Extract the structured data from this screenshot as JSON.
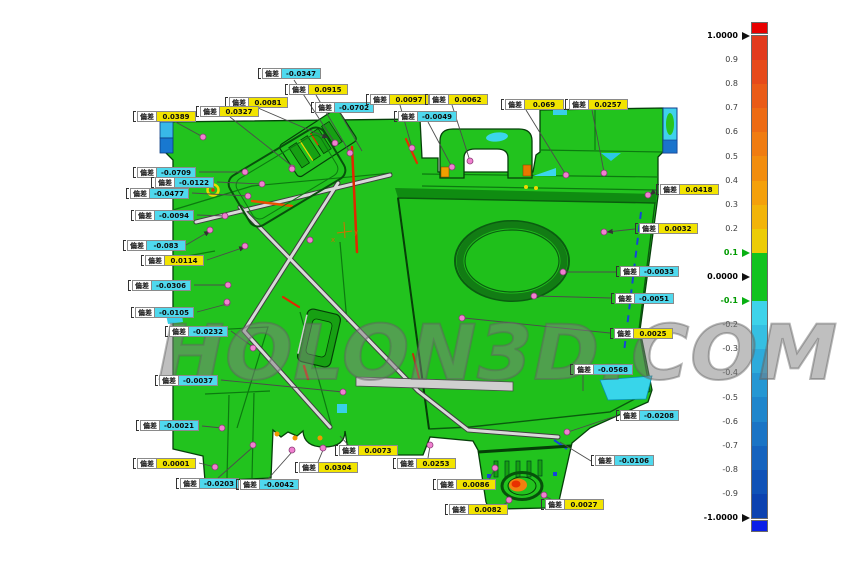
{
  "annotation_tag": "偏差",
  "watermark": {
    "text": "HOLON3D.COM"
  },
  "colors": {
    "positive_bg": "#f2e400",
    "negative_bg": "#4fd9ee",
    "part_green": "#22c31e",
    "measure_point": "#f080d0",
    "overflow_red": "#e80000",
    "underflow_blue": "#0b1fe8",
    "hotspot_orange": "#f08010"
  },
  "annotations": [
    {
      "value": "-0.0347",
      "x": 258,
      "y": 68,
      "leader": [
        294,
        80,
        335,
        143
      ],
      "dot": [
        335,
        143
      ]
    },
    {
      "value": "0.0915",
      "x": 285,
      "y": 84,
      "leader": [
        316,
        95,
        350,
        153
      ],
      "dot": [
        350,
        153
      ]
    },
    {
      "value": "0.0081",
      "x": 225,
      "y": 97,
      "leader": [
        258,
        108,
        328,
        138
      ],
      "arrow": true
    },
    {
      "value": "0.0327",
      "x": 196,
      "y": 106,
      "leader": [
        230,
        117,
        292,
        166
      ],
      "dot": [
        292,
        168
      ]
    },
    {
      "value": "0.0389",
      "x": 133,
      "y": 111,
      "leader": [
        172,
        120,
        203,
        137
      ],
      "dot": [
        203,
        137
      ]
    },
    {
      "value": "-0.0702",
      "x": 311,
      "y": 102,
      "leader": [
        340,
        113,
        362,
        151
      ]
    },
    {
      "value": "0.0097",
      "x": 366,
      "y": 94,
      "leader": [
        400,
        105,
        412,
        148
      ],
      "dot": [
        412,
        148
      ]
    },
    {
      "value": "0.0062",
      "x": 425,
      "y": 94,
      "leader": [
        452,
        105,
        470,
        161
      ],
      "dot": [
        470,
        161
      ]
    },
    {
      "value": "-0.0049",
      "x": 394,
      "y": 111,
      "leader": [
        428,
        122,
        452,
        167
      ],
      "dot": [
        452,
        167
      ]
    },
    {
      "value": "0.069",
      "x": 501,
      "y": 99,
      "leader": [
        526,
        110,
        566,
        175
      ],
      "dot": [
        566,
        175
      ]
    },
    {
      "value": "0.0257",
      "x": 565,
      "y": 99,
      "leader": [
        592,
        110,
        604,
        172
      ],
      "dot": [
        604,
        173
      ]
    },
    {
      "value": "-0.0709",
      "x": 133,
      "y": 167,
      "leader": [
        199,
        172,
        245,
        172
      ],
      "dot": [
        245,
        172
      ]
    },
    {
      "value": "-0.0122",
      "x": 151,
      "y": 177,
      "leader": [
        217,
        182,
        262,
        184
      ],
      "dot": [
        262,
        184
      ]
    },
    {
      "value": "-0.0477",
      "x": 126,
      "y": 188,
      "leader": [
        192,
        193,
        248,
        196
      ],
      "dot": [
        248,
        196
      ]
    },
    {
      "value": "-0.0094",
      "x": 131,
      "y": 210,
      "leader": [
        197,
        215,
        225,
        216
      ],
      "dot": [
        225,
        216
      ]
    },
    {
      "value": "-0.083",
      "x": 123,
      "y": 240,
      "leader": [
        186,
        245,
        210,
        231
      ],
      "arrow": true,
      "dot": [
        210,
        230
      ]
    },
    {
      "value": "0.0114",
      "x": 141,
      "y": 255,
      "leader": [
        207,
        260,
        245,
        247
      ],
      "arrow": true,
      "dot": [
        245,
        246
      ]
    },
    {
      "value": "-0.0306",
      "x": 128,
      "y": 280,
      "leader": [
        194,
        285,
        228,
        285
      ],
      "dot": [
        228,
        285
      ]
    },
    {
      "value": "-0.0105",
      "x": 131,
      "y": 307,
      "leader": [
        197,
        312,
        227,
        304
      ],
      "dot": [
        227,
        303
      ]
    },
    {
      "value": "-0.0232",
      "x": 165,
      "y": 326,
      "leader": [
        231,
        331,
        253,
        347
      ],
      "dot": [
        253,
        348
      ]
    },
    {
      "value": "-0.0037",
      "x": 155,
      "y": 375,
      "leader": [
        221,
        380,
        343,
        392
      ],
      "dot": [
        343,
        392
      ]
    },
    {
      "value": "-0.0021",
      "x": 136,
      "y": 420,
      "leader": [
        202,
        426,
        222,
        428
      ],
      "dot": [
        222,
        428
      ]
    },
    {
      "value": "0.0001",
      "x": 133,
      "y": 458,
      "leader": [
        199,
        463,
        215,
        467
      ],
      "dot": [
        215,
        467
      ]
    },
    {
      "value": "-0.0203",
      "x": 176,
      "y": 478,
      "leader": [
        218,
        478,
        253,
        447
      ],
      "dot": [
        253,
        445
      ]
    },
    {
      "value": "-0.0042",
      "x": 236,
      "y": 479,
      "leader": [
        268,
        479,
        292,
        452
      ],
      "dot": [
        292,
        450
      ]
    },
    {
      "value": "0.0304",
      "x": 295,
      "y": 462,
      "leader": [
        318,
        462,
        323,
        450
      ],
      "dot": [
        323,
        448
      ]
    },
    {
      "value": "0.0073",
      "x": 335,
      "y": 445,
      "leader": [
        352,
        449,
        340,
        436
      ]
    },
    {
      "value": "0.0253",
      "x": 393,
      "y": 458,
      "leader": [
        428,
        458,
        430,
        446
      ],
      "dot": [
        430,
        445
      ]
    },
    {
      "value": "0.0086",
      "x": 433,
      "y": 479,
      "leader": [
        487,
        483,
        495,
        469
      ],
      "dot": [
        495,
        468
      ]
    },
    {
      "value": "0.0082",
      "x": 445,
      "y": 504,
      "leader": [
        499,
        508,
        509,
        501
      ],
      "dot": [
        509,
        500
      ]
    },
    {
      "value": "0.0027",
      "x": 541,
      "y": 499,
      "leader": [
        556,
        502,
        545,
        496
      ],
      "dot": [
        544,
        495
      ]
    },
    {
      "value": "0.0418",
      "x": 656,
      "y": 184,
      "leader": [
        656,
        190,
        650,
        195
      ],
      "arrow": true,
      "dot": [
        648,
        195
      ]
    },
    {
      "value": "0.0032",
      "x": 635,
      "y": 223,
      "leader": [
        635,
        229,
        607,
        232
      ],
      "arrow": true,
      "dot": [
        604,
        232
      ]
    },
    {
      "value": "-0.0033",
      "x": 616,
      "y": 266,
      "leader": [
        616,
        272,
        565,
        272
      ],
      "dot": [
        563,
        272
      ]
    },
    {
      "value": "-0.0051",
      "x": 611,
      "y": 293,
      "leader": [
        611,
        298,
        536,
        296
      ],
      "dot": [
        534,
        296
      ]
    },
    {
      "value": "0.0025",
      "x": 610,
      "y": 328,
      "leader": [
        610,
        333,
        464,
        318
      ],
      "dot": [
        462,
        318
      ]
    },
    {
      "value": "-0.0568",
      "x": 570,
      "y": 364,
      "leader": [
        583,
        375,
        583,
        391
      ]
    },
    {
      "value": "-0.0208",
      "x": 616,
      "y": 410,
      "leader": [
        616,
        416,
        568,
        432
      ],
      "dot": [
        567,
        432
      ]
    },
    {
      "value": "-0.0106",
      "x": 591,
      "y": 455,
      "leader": [
        591,
        461,
        560,
        442
      ]
    }
  ],
  "extra_points": [
    [
      310,
      240
    ],
    [
      292,
      169
    ],
    [
      227,
      302
    ]
  ],
  "scale": {
    "ticks": [
      {
        "v": "1.0000",
        "major": true,
        "ptr": "black"
      },
      {
        "v": "0.9"
      },
      {
        "v": "0.8"
      },
      {
        "v": "0.7"
      },
      {
        "v": "0.6"
      },
      {
        "v": "0.5"
      },
      {
        "v": "0.4"
      },
      {
        "v": "0.3"
      },
      {
        "v": "0.2"
      },
      {
        "v": "0.1",
        "green": true,
        "ptr": "green"
      },
      {
        "v": "0.0000",
        "major": true,
        "ptr": "black"
      },
      {
        "v": "-0.1",
        "green": true,
        "ptr": "green"
      },
      {
        "v": "-0.2"
      },
      {
        "v": "-0.3"
      },
      {
        "v": "-0.4"
      },
      {
        "v": "-0.5"
      },
      {
        "v": "-0.6"
      },
      {
        "v": "-0.7"
      },
      {
        "v": "-0.8"
      },
      {
        "v": "-0.9"
      },
      {
        "v": "-1.0000",
        "major": true,
        "ptr": "black"
      }
    ],
    "segments": [
      "#e23a1d",
      "#e64a1a",
      "#ea5b17",
      "#ed6b14",
      "#f07c11",
      "#f28d0e",
      "#f4a00b",
      "#f2b409",
      "#eccc06",
      "#12c31f",
      "#12c31f",
      "#3ed3ea",
      "#35bfe2",
      "#2dabdb",
      "#2597d3",
      "#1f86cc",
      "#1a74c5",
      "#1563be",
      "#1052b7",
      "#0c42b0"
    ]
  }
}
